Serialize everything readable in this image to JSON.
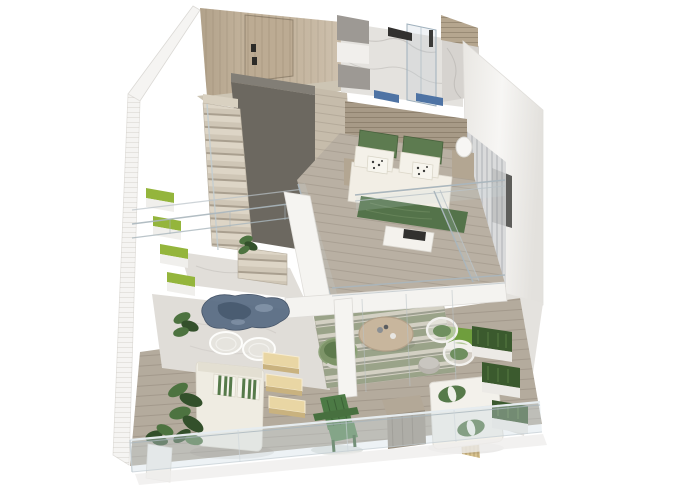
{
  "meta": {
    "type": "3d-isometric-floor-plan-render",
    "subject": "two-storey loft apartment cutaway render",
    "width_px": 680,
    "height_px": 486,
    "background": "#ffffff",
    "visible_text": ""
  },
  "palette": {
    "bg": "#ffffff",
    "wall_white": "#f5f4f2",
    "wall_shade": "#e4e2de",
    "wood_wall": "#c4b49d",
    "wood_door": "#bcab93",
    "door_handle": "#2c2b28",
    "floor_sliver": "#cdc5b4",
    "hall_floor": "#c6bcab",
    "core_gray": "#6c6860",
    "core_gray_top": "#827e76",
    "tread_light": "#d9d1c1",
    "landing_marble": "#e1ded9",
    "marble": "#e4e2de",
    "marble_wall": "#d6d3cf",
    "slat_cabinet": "#b5a68f",
    "wardrobe_gray": "#9d9994",
    "wardrobe_white": "#f1efec",
    "accent_blue": "#4e73a4",
    "headboard_wood": "#a79a87",
    "plank_floor": "#b9b0a3",
    "bed_white": "#f2eee5",
    "pillow_green": "#5d7b50",
    "blanket_green": "#54734a",
    "bench_white": "#f4f2ed",
    "tv_dark": "#32312f",
    "nightstand_wood": "#b3a692",
    "lamp_white": "#f7f6f4",
    "curtain_gray": "#d5d6d7",
    "panel_dark": "#4c4c4a",
    "partition_white": "#f5f4f1",
    "fascia_white": "#f4f3f0",
    "deck_wood": "#b4ab9d",
    "lounge_marble": "#e0ddd8",
    "rug_blue": "#5b6e85",
    "rug_blue_dark": "#45566c",
    "rug_blue_light": "#8c9cb0",
    "wire_white": "#f4f3f0",
    "daybed_white": "#efece2",
    "stripe_green": "#567a4a",
    "step_glow": "#e9d6a4",
    "step_side": "#c9b27f",
    "plant_dark": "#33502b",
    "plant_mid": "#4d7340",
    "planter_green": "#94b53c",
    "planter_white": "#f0efec",
    "rug_base": "#d3d0c3",
    "table_wood": "#c8b69d",
    "papasan_outer": "#7d9468",
    "papasan_inner": "#5e7a4d",
    "pouf_gray": "#b8b4ad",
    "sofa_white": "#f3f1eb",
    "hedge_green": "#3b5a2e",
    "hedge_box": "#eceae6",
    "rattan": "#d7c28f",
    "adirondack": "#4c7a45",
    "adirondack_dark": "#3c6136",
    "glass_tint": "#cfdde6",
    "glass_rail": "#aab6bd",
    "shadow": "#efeeec",
    "interior_hedge": "#6f9e3d"
  },
  "scene": {
    "levels": [
      {
        "name": "upper-level",
        "areas": [
          {
            "name": "entry",
            "features": [
              "wood-panel-wall",
              "entry-door",
              "door-handles"
            ]
          },
          {
            "name": "bathroom",
            "features": [
              "marble-floor",
              "marble-wall",
              "glass-shower",
              "black-fixtures",
              "wood-slat-cabinet",
              "wardrobe-blocks",
              "blue-towel-accents"
            ]
          },
          {
            "name": "bedroom",
            "features": [
              "slat-headboard-wall",
              "double-bed",
              "green-pillows",
              "floral-cushions",
              "green-blanket",
              "nightstands",
              "white-lamp",
              "tv-bench",
              "glass-balustrade",
              "sheer-curtains",
              "dark-wall-panel"
            ]
          },
          {
            "name": "staircase",
            "features": [
              "dark-stair-core",
              "wood-treads",
              "glass-screen",
              "marble-landing",
              "potted-plant"
            ]
          }
        ]
      },
      {
        "name": "lower-level",
        "areas": [
          {
            "name": "planter-wall",
            "features": [
              "stacked-green-planters",
              "white-slat-wall",
              "void-railings"
            ]
          },
          {
            "name": "lounge",
            "features": [
              "marble-floor",
              "blue-area-rug",
              "wire-chairs",
              "daybed",
              "green-striped-pillows",
              "lit-steps",
              "leafy-plants",
              "planter-bin"
            ]
          },
          {
            "name": "dining",
            "features": [
              "striped-rug",
              "round-wood-table",
              "papasan-chair",
              "wire-chairs-green-cushion",
              "gray-pouf",
              "interior-hedge-box"
            ]
          },
          {
            "name": "terrace",
            "features": [
              "wood-deck",
              "adirondack-chair",
              "wood-block-table",
              "white-sofa",
              "green-bolster-pillows",
              "stepped-hedge-planters",
              "rattan-screen",
              "glass-sliding-doors",
              "front-glass-balustrade"
            ]
          }
        ]
      }
    ]
  }
}
